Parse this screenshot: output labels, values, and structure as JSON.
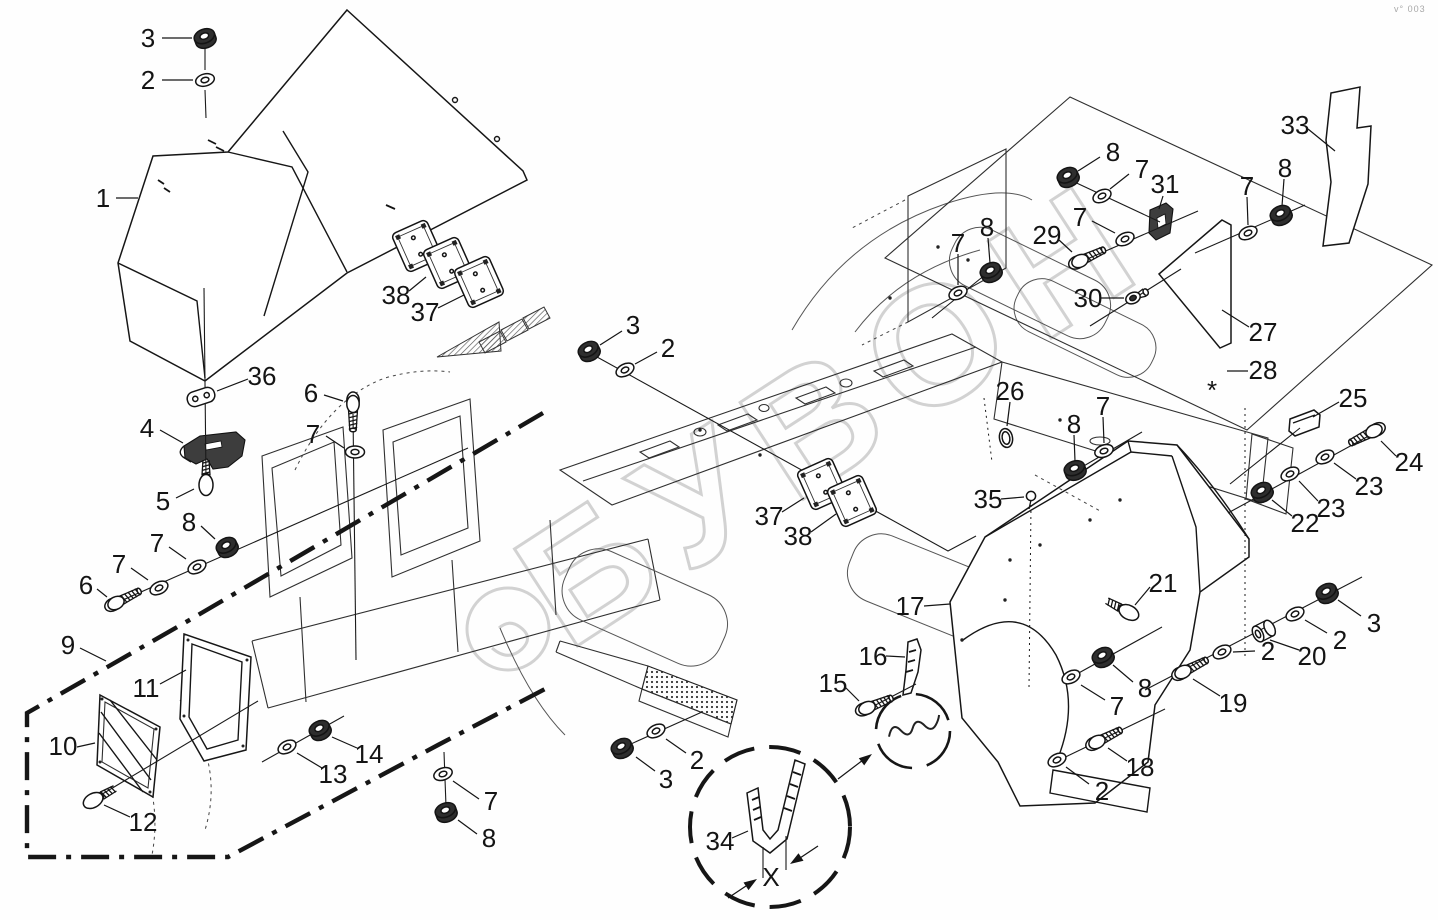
{
  "page": {
    "background": "#fefefe",
    "corner_mark": "v° 003",
    "watermark": {
      "text": "БУВОН",
      "color": "#c8c8c8"
    }
  },
  "diagram": {
    "type": "exploded-parts-diagram",
    "line_color": "#1a1a1a",
    "symbols": {
      "dimension": "X",
      "footnote": "*"
    },
    "callouts": [
      {
        "n": "1",
        "x": 103,
        "y": 198,
        "l": [
          116,
          198,
          138,
          198
        ]
      },
      {
        "n": "2",
        "x": 148,
        "y": 80,
        "l": [
          162,
          80,
          193,
          80
        ]
      },
      {
        "n": "3",
        "x": 148,
        "y": 38,
        "l": [
          162,
          38,
          192,
          38
        ]
      },
      {
        "n": "36",
        "x": 262,
        "y": 376,
        "l": [
          248,
          379,
          217,
          391
        ]
      },
      {
        "n": "4",
        "x": 147,
        "y": 428,
        "l": [
          160,
          430,
          183,
          443
        ]
      },
      {
        "n": "5",
        "x": 163,
        "y": 501,
        "l": [
          176,
          498,
          194,
          489
        ]
      },
      {
        "n": "6",
        "x": 311,
        "y": 393,
        "l": [
          324,
          395,
          343,
          401
        ]
      },
      {
        "n": "7",
        "x": 313,
        "y": 434,
        "l": [
          326,
          436,
          344,
          448
        ]
      },
      {
        "n": "8",
        "x": 189,
        "y": 522,
        "l": [
          201,
          526,
          215,
          539
        ]
      },
      {
        "n": "7",
        "x": 157,
        "y": 543,
        "l": [
          169,
          547,
          186,
          559
        ]
      },
      {
        "n": "7",
        "x": 119,
        "y": 564,
        "l": [
          131,
          568,
          148,
          580
        ]
      },
      {
        "n": "6",
        "x": 86,
        "y": 585,
        "l": [
          97,
          589,
          107,
          597
        ]
      },
      {
        "n": "9",
        "x": 68,
        "y": 645,
        "l": [
          80,
          648,
          106,
          661
        ]
      },
      {
        "n": "11",
        "x": 146,
        "y": 688,
        "l": [
          160,
          684,
          186,
          670
        ]
      },
      {
        "n": "10",
        "x": 63,
        "y": 746,
        "l": [
          77,
          747,
          95,
          743
        ]
      },
      {
        "n": "12",
        "x": 143,
        "y": 822,
        "l": [
          130,
          817,
          104,
          805
        ]
      },
      {
        "n": "13",
        "x": 333,
        "y": 774,
        "l": [
          322,
          768,
          297,
          753
        ]
      },
      {
        "n": "14",
        "x": 369,
        "y": 754,
        "l": [
          357,
          748,
          332,
          737
        ]
      },
      {
        "n": "7",
        "x": 491,
        "y": 801,
        "l": [
          479,
          799,
          453,
          781
        ]
      },
      {
        "n": "8",
        "x": 489,
        "y": 838,
        "l": [
          477,
          834,
          458,
          820
        ]
      },
      {
        "n": "3",
        "x": 633,
        "y": 325,
        "l": [
          622,
          331,
          600,
          345
        ]
      },
      {
        "n": "2",
        "x": 668,
        "y": 348,
        "l": [
          657,
          352,
          635,
          364
        ]
      },
      {
        "n": "38",
        "x": 396,
        "y": 295,
        "l": [
          409,
          291,
          426,
          277
        ]
      },
      {
        "n": "37",
        "x": 425,
        "y": 312,
        "l": [
          438,
          308,
          464,
          295
        ]
      },
      {
        "n": "37",
        "x": 769,
        "y": 516,
        "l": [
          782,
          512,
          804,
          498
        ]
      },
      {
        "n": "38",
        "x": 798,
        "y": 536,
        "l": [
          811,
          532,
          836,
          514
        ]
      },
      {
        "n": "35",
        "x": 988,
        "y": 499,
        "l": [
          1001,
          499,
          1024,
          497
        ]
      },
      {
        "n": "26",
        "x": 1010,
        "y": 391,
        "l": [
          1010,
          402,
          1007,
          426
        ]
      },
      {
        "n": "7",
        "x": 1103,
        "y": 406,
        "l": [
          1103,
          417,
          1104,
          443
        ]
      },
      {
        "n": "8",
        "x": 1074,
        "y": 424,
        "l": [
          1074,
          435,
          1075,
          461
        ]
      },
      {
        "n": "17",
        "x": 910,
        "y": 606,
        "l": [
          924,
          606,
          950,
          604
        ]
      },
      {
        "n": "21",
        "x": 1163,
        "y": 583,
        "l": [
          1150,
          587,
          1135,
          605
        ]
      },
      {
        "n": "8",
        "x": 1145,
        "y": 688,
        "l": [
          1133,
          682,
          1113,
          665
        ]
      },
      {
        "n": "7",
        "x": 1117,
        "y": 706,
        "l": [
          1105,
          700,
          1081,
          685
        ]
      },
      {
        "n": "18",
        "x": 1140,
        "y": 767,
        "l": [
          1127,
          761,
          1108,
          748
        ]
      },
      {
        "n": "2",
        "x": 1102,
        "y": 791,
        "l": [
          1089,
          784,
          1066,
          767
        ]
      },
      {
        "n": "19",
        "x": 1233,
        "y": 703,
        "l": [
          1220,
          696,
          1193,
          679
        ]
      },
      {
        "n": "2",
        "x": 1268,
        "y": 651,
        "l": [
          1255,
          651,
          1233,
          652
        ]
      },
      {
        "n": "20",
        "x": 1312,
        "y": 656,
        "l": [
          1299,
          650,
          1270,
          640
        ]
      },
      {
        "n": "2",
        "x": 1340,
        "y": 640,
        "l": [
          1327,
          633,
          1305,
          620
        ]
      },
      {
        "n": "3",
        "x": 1374,
        "y": 623,
        "l": [
          1361,
          616,
          1338,
          600
        ]
      },
      {
        "n": "22",
        "x": 1305,
        "y": 523,
        "l": [
          1292,
          516,
          1272,
          500
        ]
      },
      {
        "n": "23",
        "x": 1331,
        "y": 508,
        "l": [
          1318,
          501,
          1299,
          481
        ]
      },
      {
        "n": "23",
        "x": 1369,
        "y": 486,
        "l": [
          1356,
          479,
          1334,
          463
        ]
      },
      {
        "n": "24",
        "x": 1409,
        "y": 462,
        "l": [
          1396,
          456,
          1381,
          441
        ]
      },
      {
        "n": "25",
        "x": 1353,
        "y": 398,
        "l": [
          1339,
          402,
          1313,
          417
        ]
      },
      {
        "n": "33",
        "x": 1295,
        "y": 125,
        "l": [
          1308,
          129,
          1335,
          151
        ]
      },
      {
        "n": "27",
        "x": 1263,
        "y": 332,
        "l": [
          1249,
          327,
          1222,
          310
        ]
      },
      {
        "n": "28",
        "x": 1263,
        "y": 370,
        "l": [
          1248,
          371,
          1227,
          371
        ]
      },
      {
        "n": "*",
        "x": 1212,
        "y": 371,
        "s": 58,
        "dy": 19
      },
      {
        "n": "31",
        "x": 1165,
        "y": 184,
        "l": [
          1163,
          196,
          1159,
          209
        ]
      },
      {
        "n": "8",
        "x": 1113,
        "y": 152,
        "l": [
          1100,
          157,
          1078,
          171
        ]
      },
      {
        "n": "7",
        "x": 1142,
        "y": 169,
        "l": [
          1129,
          174,
          1110,
          189
        ]
      },
      {
        "n": "7",
        "x": 1080,
        "y": 217,
        "l": [
          1092,
          221,
          1115,
          233
        ]
      },
      {
        "n": "29",
        "x": 1047,
        "y": 235,
        "l": [
          1059,
          240,
          1072,
          252
        ]
      },
      {
        "n": "30",
        "x": 1088,
        "y": 298,
        "l": [
          1101,
          298,
          1124,
          298
        ]
      },
      {
        "n": "7",
        "x": 1247,
        "y": 186,
        "l": [
          1247,
          197,
          1248,
          225
        ]
      },
      {
        "n": "8",
        "x": 1285,
        "y": 168,
        "l": [
          1284,
          179,
          1282,
          206
        ]
      },
      {
        "n": "8",
        "x": 987,
        "y": 227,
        "l": [
          988,
          238,
          990,
          263
        ]
      },
      {
        "n": "7",
        "x": 958,
        "y": 243,
        "l": [
          958,
          254,
          958,
          285
        ]
      },
      {
        "n": "16",
        "x": 873,
        "y": 656,
        "l": [
          886,
          656,
          905,
          657
        ]
      },
      {
        "n": "15",
        "x": 833,
        "y": 683,
        "l": [
          845,
          687,
          859,
          701
        ]
      },
      {
        "n": "34",
        "x": 720,
        "y": 841,
        "l": [
          732,
          838,
          748,
          831
        ]
      },
      {
        "n": "2",
        "x": 697,
        "y": 760,
        "l": [
          686,
          753,
          666,
          739
        ]
      },
      {
        "n": "3",
        "x": 666,
        "y": 779,
        "l": [
          655,
          771,
          636,
          757
        ]
      },
      {
        "n": "X",
        "x": 771,
        "y": 877,
        "s": 24
      }
    ],
    "fasteners": [
      {
        "t": "nut",
        "x": 205,
        "y": 38,
        "a": -20,
        "dark": true
      },
      {
        "t": "washer",
        "x": 205,
        "y": 80,
        "a": -15
      },
      {
        "t": "link",
        "x": 201,
        "y": 397,
        "a": -18
      },
      {
        "t": "screw",
        "x": 206,
        "y": 484,
        "a": -90
      },
      {
        "t": "bolt",
        "x": 353,
        "y": 404,
        "a": 90
      },
      {
        "t": "washer",
        "x": 355,
        "y": 452,
        "a": 0
      },
      {
        "t": "bolt",
        "x": 116,
        "y": 603,
        "a": -27
      },
      {
        "t": "washer",
        "x": 159,
        "y": 588,
        "a": -27
      },
      {
        "t": "washer",
        "x": 197,
        "y": 567,
        "a": -27
      },
      {
        "t": "nut",
        "x": 227,
        "y": 547,
        "a": -27,
        "dark": true
      },
      {
        "t": "screw",
        "x": 94,
        "y": 800,
        "a": -29
      },
      {
        "t": "washer",
        "x": 287,
        "y": 747,
        "a": -27
      },
      {
        "t": "nut",
        "x": 320,
        "y": 730,
        "a": -27,
        "dark": true
      },
      {
        "t": "washer",
        "x": 443,
        "y": 774,
        "a": -20
      },
      {
        "t": "nut",
        "x": 446,
        "y": 812,
        "a": -20,
        "dark": true
      },
      {
        "t": "nut",
        "x": 589,
        "y": 351,
        "a": -27,
        "dark": true
      },
      {
        "t": "washer",
        "x": 625,
        "y": 370,
        "a": -27
      },
      {
        "t": "nut",
        "x": 622,
        "y": 748,
        "a": -27,
        "dark": true
      },
      {
        "t": "washer",
        "x": 656,
        "y": 731,
        "a": -27
      },
      {
        "t": "pin",
        "x": 1031,
        "y": 496,
        "a": 0
      },
      {
        "t": "oval",
        "x": 1006,
        "y": 438,
        "a": -10
      },
      {
        "t": "washer",
        "x": 958,
        "y": 293,
        "a": -25
      },
      {
        "t": "nut",
        "x": 991,
        "y": 272,
        "a": -25,
        "dark": true
      },
      {
        "t": "nut",
        "x": 1068,
        "y": 177,
        "a": -25,
        "dark": true
      },
      {
        "t": "washer",
        "x": 1102,
        "y": 196,
        "a": -25
      },
      {
        "t": "washer",
        "x": 1125,
        "y": 239,
        "a": -25
      },
      {
        "t": "bolt",
        "x": 1080,
        "y": 261,
        "a": -25
      },
      {
        "t": "grommet",
        "x": 1133,
        "y": 298,
        "a": -25
      },
      {
        "t": "washer",
        "x": 1248,
        "y": 233,
        "a": -25
      },
      {
        "t": "nut",
        "x": 1281,
        "y": 215,
        "a": -25,
        "dark": true
      },
      {
        "t": "washer",
        "x": 1104,
        "y": 451,
        "a": -20
      },
      {
        "t": "nut",
        "x": 1075,
        "y": 470,
        "a": -20,
        "dark": true
      },
      {
        "t": "screw",
        "x": 1128,
        "y": 612,
        "a": -152
      },
      {
        "t": "nut",
        "x": 1103,
        "y": 657,
        "a": -27,
        "dark": true
      },
      {
        "t": "washer",
        "x": 1071,
        "y": 677,
        "a": -27
      },
      {
        "t": "bolt",
        "x": 1097,
        "y": 742,
        "a": -27
      },
      {
        "t": "washer",
        "x": 1057,
        "y": 760,
        "a": -27
      },
      {
        "t": "bolt",
        "x": 1183,
        "y": 672,
        "a": -27
      },
      {
        "t": "washer",
        "x": 1222,
        "y": 652,
        "a": -27
      },
      {
        "t": "spacer",
        "x": 1258,
        "y": 634,
        "a": -27
      },
      {
        "t": "washer",
        "x": 1295,
        "y": 614,
        "a": -27
      },
      {
        "t": "nut",
        "x": 1327,
        "y": 593,
        "a": -27,
        "dark": true
      },
      {
        "t": "nut",
        "x": 1262,
        "y": 492,
        "a": -27,
        "dark": true
      },
      {
        "t": "washer",
        "x": 1290,
        "y": 474,
        "a": -27
      },
      {
        "t": "washer",
        "x": 1325,
        "y": 457,
        "a": -27
      },
      {
        "t": "bolt",
        "x": 1374,
        "y": 431,
        "a": 153
      },
      {
        "t": "bolt",
        "x": 867,
        "y": 708,
        "a": -22
      },
      {
        "t": "plate",
        "x": 417,
        "y": 246,
        "a": -24
      },
      {
        "t": "plate",
        "x": 448,
        "y": 263,
        "a": -24
      },
      {
        "t": "plate",
        "x": 479,
        "y": 282,
        "a": -24
      },
      {
        "t": "plate",
        "x": 822,
        "y": 484,
        "a": -24
      },
      {
        "t": "plate",
        "x": 852,
        "y": 501,
        "a": -24
      }
    ],
    "axis_lines": [
      [
        205,
        48,
        205,
        70
      ],
      [
        205,
        90,
        206,
        118
      ],
      [
        204,
        288,
        206,
        478
      ],
      [
        353,
        414,
        356,
        660
      ],
      [
        116,
        603,
        468,
        448
      ],
      [
        94,
        799,
        258,
        701
      ],
      [
        262,
        762,
        344,
        716
      ],
      [
        444,
        752,
        446,
        806
      ],
      [
        622,
        748,
        702,
        712
      ],
      [
        991,
        270,
        932,
        318
      ],
      [
        1068,
        179,
        1160,
        222
      ],
      [
        1078,
        263,
        1198,
        211
      ],
      [
        1195,
        253,
        1305,
        205
      ],
      [
        1090,
        326,
        1181,
        269
      ],
      [
        1070,
        474,
        1142,
        432
      ],
      [
        1066,
        680,
        1162,
        627
      ],
      [
        1053,
        763,
        1165,
        709
      ],
      [
        1145,
        690,
        1362,
        577
      ],
      [
        1228,
        513,
        1385,
        427
      ],
      [
        1230,
        484,
        1300,
        428
      ],
      [
        862,
        712,
        916,
        684
      ]
    ],
    "dotted_lines": [
      [
        1245,
        408,
        1245,
        659
      ],
      [
        1031,
        505,
        1029,
        688
      ],
      [
        984,
        398,
        992,
        462
      ]
    ],
    "polylines": [
      {
        "pts": "588,352 948,551 976,536"
      }
    ]
  }
}
